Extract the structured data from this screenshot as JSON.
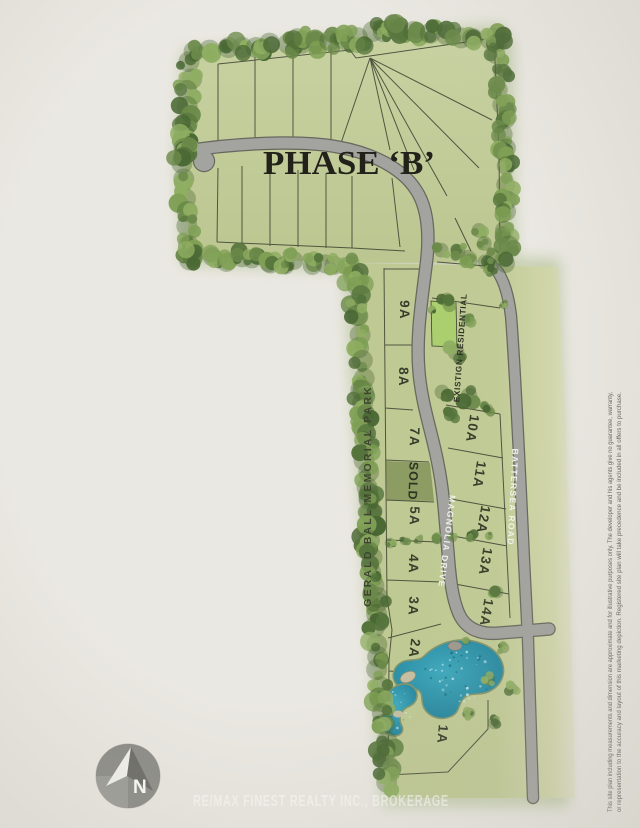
{
  "title": "PHASE ‘B’",
  "roads": {
    "park": "GERALD BALL MEMORIAL PARK",
    "center": "MAGNOLIA DRIVE",
    "east": "BATTERSEA ROAD"
  },
  "zones": {
    "existing_residential": "EXISTIGN RESIDENTIAL"
  },
  "lots": {
    "west": [
      "9A",
      "8A",
      "7A",
      "5A",
      "4A",
      "3A",
      "2A",
      "1A"
    ],
    "east": [
      "10A",
      "11A",
      "12A",
      "13A",
      "14A"
    ],
    "sold_label": "SOLD"
  },
  "compass": {
    "north_label": "N"
  },
  "footer": {
    "brokerage": "RE/MAX FINEST REALTY INC., BROKERAGE"
  },
  "disclaimer": {
    "line1": "This site plan including measurements and dimension are approximate and for illustrative purposes only. The developer and his agents give no guarantee, warranty,",
    "line2": "or representation to the accuracy and layout of this marketing depiction. Registered site plan will take precedence and be included in all offers to purchase."
  },
  "colors": {
    "paper": "#eae8e2",
    "grass": "#bfc994",
    "grass_top": "#c6d09e",
    "sold_lot": "#8c9c63",
    "highlight_lot": "#abce6e",
    "road": "#a3a39f",
    "road_casing": "#68685f",
    "lot_line": "#3c4130",
    "pond_deep": "#1f7f96",
    "pond_light": "#3fa9bd",
    "tree_palette": [
      "#55743c",
      "#6b8a4a",
      "#7fa055",
      "#8fae62",
      "#4a6834",
      "#44612f"
    ]
  }
}
